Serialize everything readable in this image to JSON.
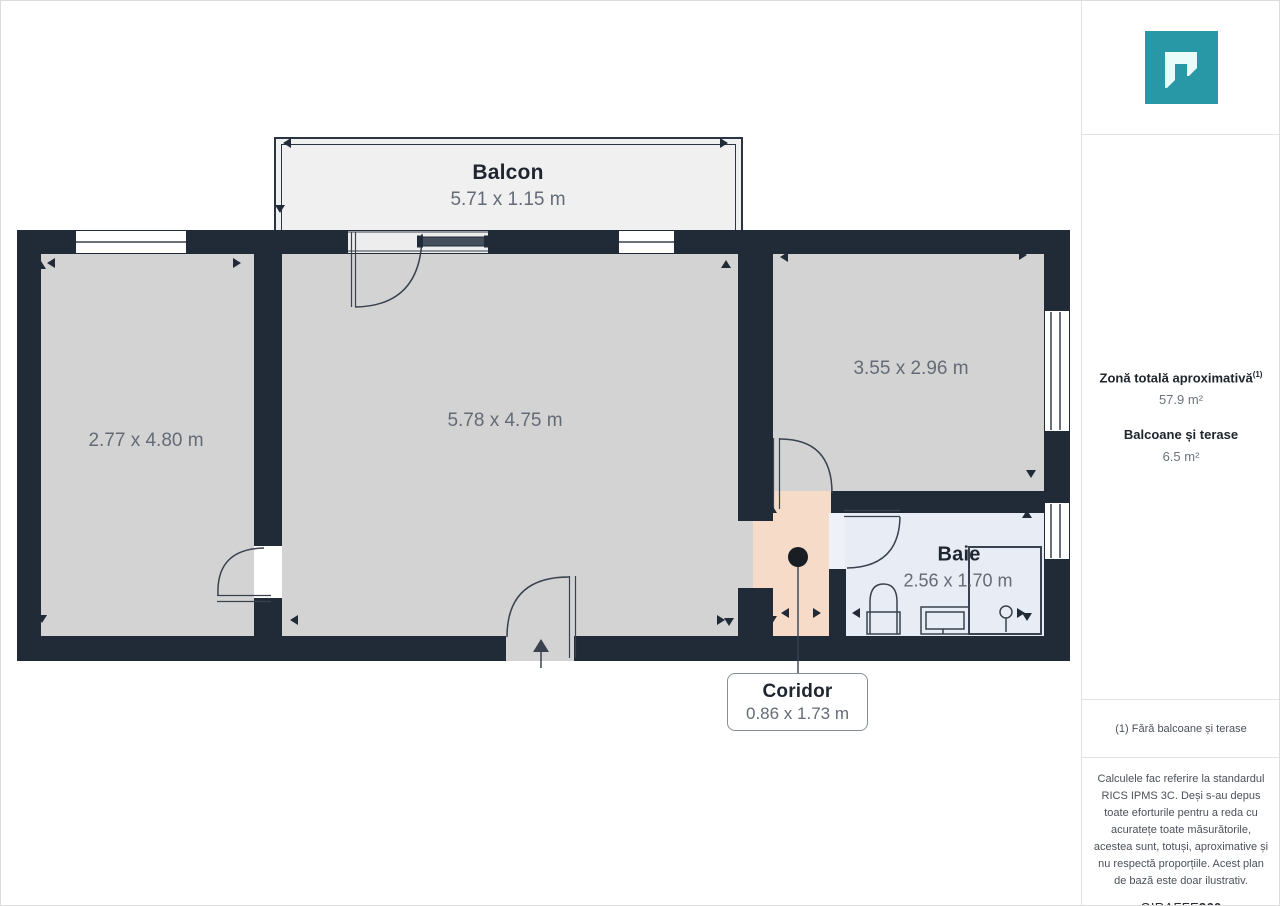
{
  "plan": {
    "rooms": {
      "balcon": {
        "name": "Balcon",
        "dims": "5.71 x 1.15 m"
      },
      "room_left": {
        "dims": "2.77 x 4.80 m"
      },
      "room_main": {
        "dims": "5.78 x 4.75 m"
      },
      "room_right": {
        "dims": "3.55 x 2.96 m"
      },
      "baie": {
        "name": "Baie",
        "dims": "2.56 x 1.70 m"
      },
      "coridor": {
        "name": "Coridor",
        "dims": "0.86 x 1.73 m"
      }
    },
    "colors": {
      "wall": "#212b38",
      "floor": "#d3d3d3",
      "balcony": "#f0f0f1",
      "corridor": "#f6dcc8",
      "bathroom": "#e8ecf5"
    }
  },
  "sidebar": {
    "logo_color": "#2898a7",
    "stats": {
      "total_label": "Zonă totală aproximativă",
      "total_sup": "(1)",
      "total_value": "57.9 m²",
      "balcony_label": "Balcoane și terase",
      "balcony_value": "6.5 m²"
    },
    "footnote": "(1) Fără balcoane și terase",
    "disclaimer": "Calculele fac referire la standardul RICS IPMS 3C. Deși s-au depus toate eforturile pentru a reda cu acuratețe toate măsurătorile, acestea sunt, totuși, aproximative și nu respectă proporțiile. Acest plan de bază este doar ilustrativ.",
    "brand_name": "GIRAFFE",
    "brand_suffix": "360"
  }
}
